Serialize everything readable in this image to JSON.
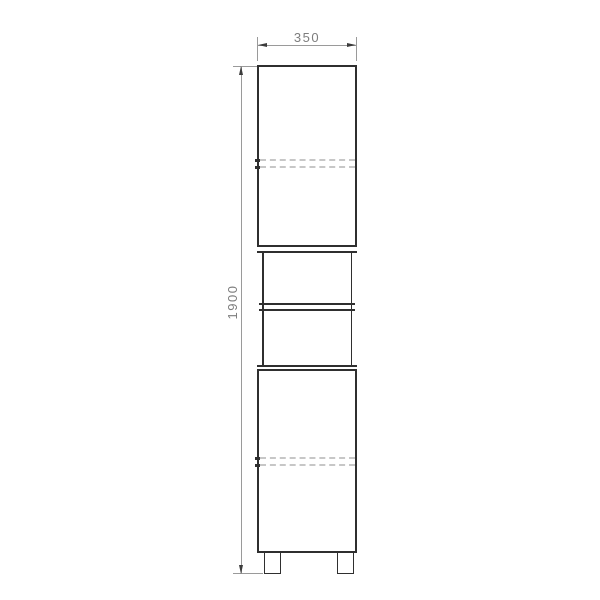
{
  "drawing": {
    "type": "furniture-front-elevation",
    "width_dimension": {
      "value": "350"
    },
    "height_dimension": {
      "value": "1900"
    },
    "colors": {
      "outline": "#2f2f2f",
      "dimension_line": "#9a9a9a",
      "dimension_text": "#7d7d7d",
      "arrow": "#3c3c3c",
      "hidden_line": "#c7c7c7",
      "background": "#ffffff"
    }
  }
}
